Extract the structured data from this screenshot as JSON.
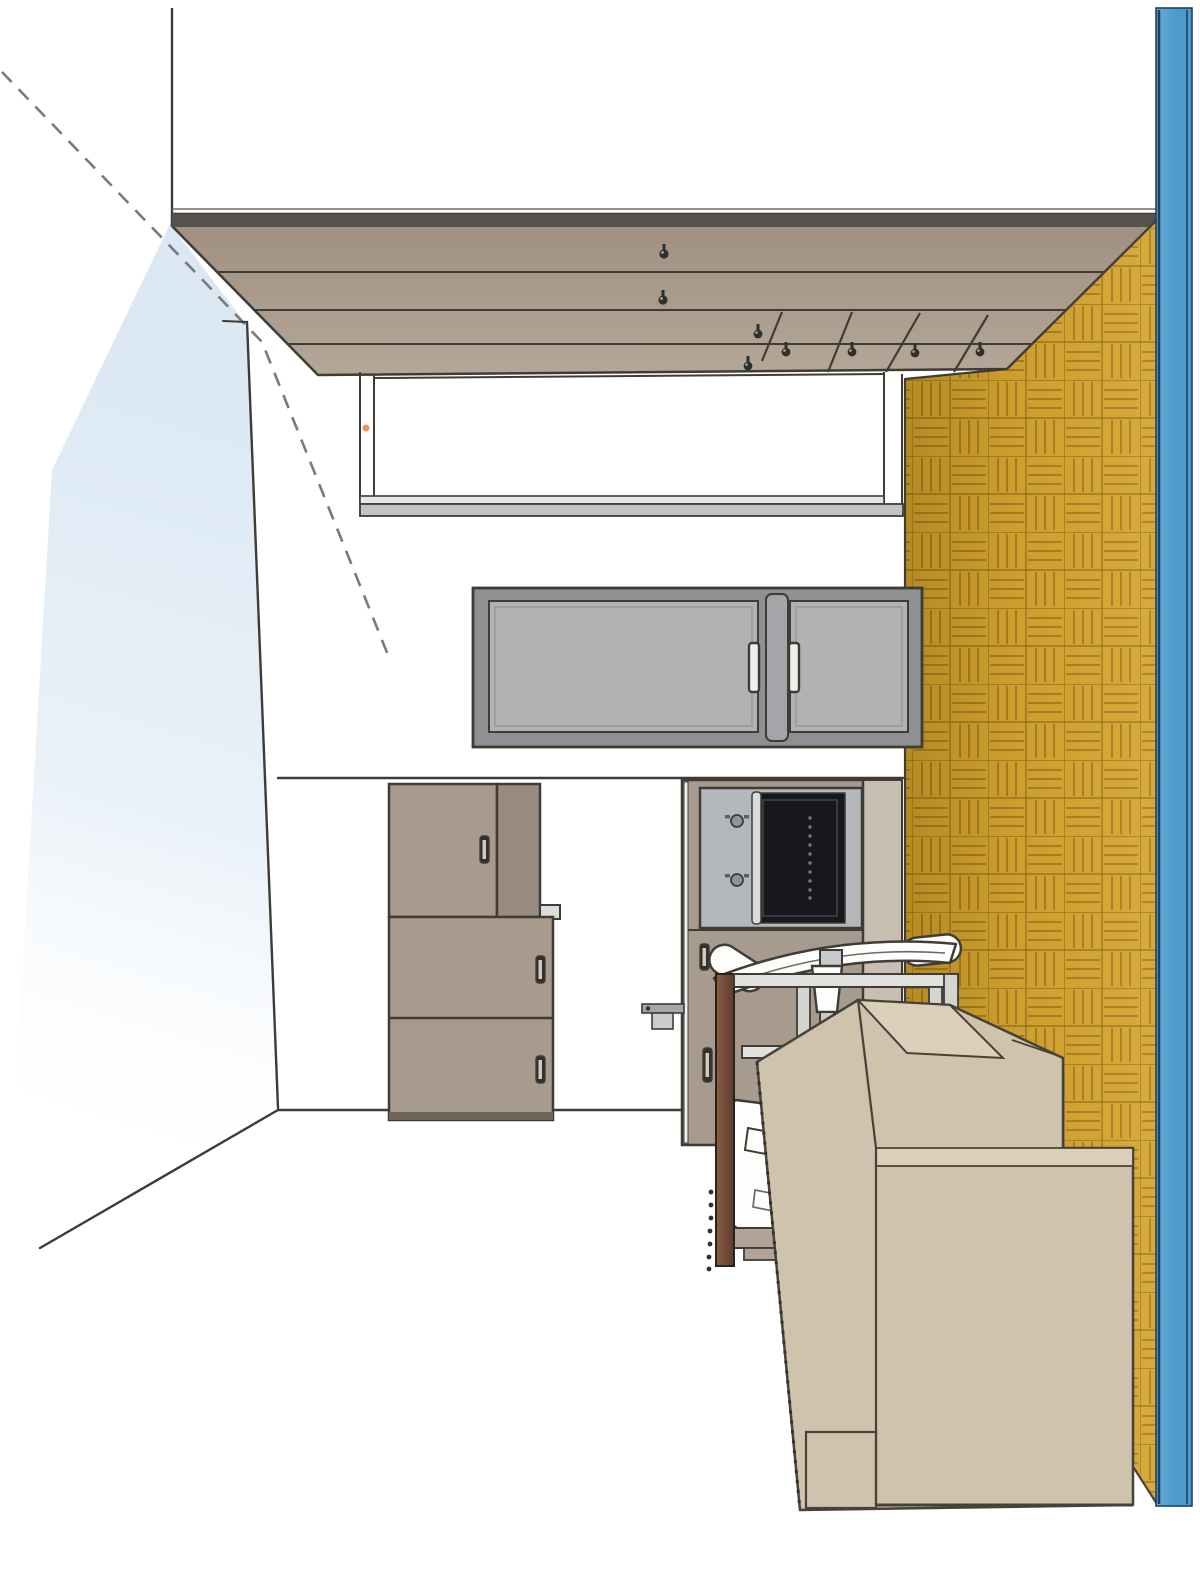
{
  "document": {
    "kind": "architectural-interior-rendering",
    "view": "one-point-perspective room view, scanned drawing",
    "background": "#ffffff"
  },
  "colors": {
    "line": "#3f3c36",
    "line_soft": "#6b6b66",
    "dash": "#7a7a78",
    "wall_tint": "#d9e7f3",
    "ceiling_dark_band": "#55514b",
    "ceiling_top": "#9d8e80",
    "ceiling_bottom": "#b5a798",
    "parquet_base": "#d4a531",
    "parquet_groove": "#a87e22",
    "parquet_seam": "#8a6a1c",
    "blue_panel": "#4d9bca",
    "blue_panel_light": "#66acd7",
    "blue_edge": "#1c415f",
    "cabinet_frame": "#8f9093",
    "cabinet_door": "#b1b2b4",
    "cabinet_divider": "#a4a5a8",
    "handle_light": "#f0f0ee",
    "wardrobe_front": "#a89a8d",
    "wardrobe_side": "#998b7f",
    "wardrobe_base": "#6d655b",
    "ledge": "#dcdcd8",
    "column_front": "#a79a8e",
    "column_side": "#c8beb2",
    "stainless": "#b5b8bb",
    "oven_glass": "#16181c",
    "oven_glass_frame": "#3e444b",
    "oven_dot": "#737a82",
    "handle_bar": "#d9dbdd",
    "slot_dark": "#332f2a",
    "slot_light": "#cfcac2",
    "chair_white": "#fdfdfc",
    "chair_metal": "#c7cacd",
    "chair_base": "#b1a496",
    "desk_brown_1": "#8a5c43",
    "desk_brown_2": "#5c3d2e",
    "desk_rail": "#e0e0dc",
    "desk_leg": "#d4d4d0",
    "box_face": "#cfc3ad",
    "box_top": "#dbcfb9",
    "box_edge": "#46423a",
    "accent_orange": "#e8834a",
    "sill_upper": "#e6e6e4",
    "sill_lower": "#c3c3c5",
    "hook_dark": "#31302c"
  },
  "scene": {
    "elements": [
      {
        "id": "left-wall",
        "label": "left wall cut away, pale blue tint with dashed section line"
      },
      {
        "id": "ceiling",
        "label": "suspended wood-plank ceiling with 8 hanging hooks and diagonal joints"
      },
      {
        "id": "parquet-wall",
        "label": "right wall clad in golden basket-weave parquet"
      },
      {
        "id": "section-strip",
        "label": "blue section-cut strip along right edge"
      },
      {
        "id": "back-wall",
        "label": "white back wall with counter line and floor line"
      },
      {
        "id": "suspended-frame",
        "label": "thin suspended frame / hatch opening with grey sill"
      },
      {
        "id": "wall-cabinet",
        "label": "grey two-door wall cabinet with vertical handles"
      },
      {
        "id": "wardrobe",
        "label": "three-section taupe tall cabinet with slot handles"
      },
      {
        "id": "oven-column",
        "label": "tall unit with built-in black glass oven and two drawers"
      },
      {
        "id": "office-chair",
        "label": "white office chair seen from behind"
      },
      {
        "id": "desk",
        "label": "metal-frame desk with dark wood side panel"
      },
      {
        "id": "foreground-cabinets",
        "label": "stepped beige credenza volumes in foreground"
      }
    ],
    "counts": {
      "ceiling_hooks": 8,
      "ceiling_plank_lines": 3,
      "ceiling_diagonal_joints": 4,
      "wall_cabinet_doors": 2,
      "wardrobe_handles": 3,
      "oven_dials": 2,
      "drawer_slots": 2
    }
  }
}
